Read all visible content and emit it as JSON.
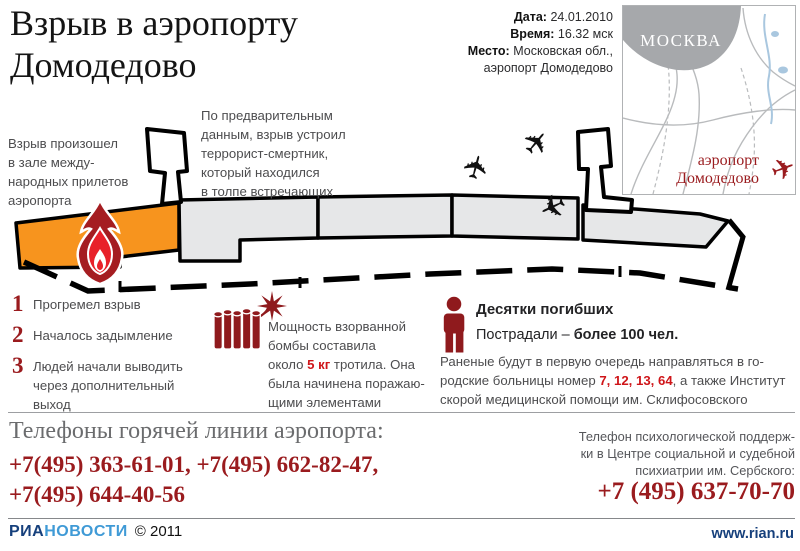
{
  "header": {
    "title": "Взрыв в аэропорту\nДомодедово",
    "meta": [
      {
        "label": "Дата:",
        "value": "24.01.2010"
      },
      {
        "label": "Время:",
        "value": "16.32 мск"
      },
      {
        "label": "Место:",
        "value": "Московская обл.,\nаэропорт Домодедово"
      }
    ]
  },
  "map": {
    "city_label": "МОСКВА",
    "airport_label": "аэропорт\nДомодедово",
    "plane_glyph": "✈"
  },
  "diagram": {
    "explosion_note": "Взрыв произошел\nв зале между-\nнародных прилетов\nаэропорта",
    "terrorist_note": "По предварительным\nданным, взрыв устроил\nтеррорист-смертник,\nкоторый находился\nв толпе встречающих",
    "plane_glyph": "✈"
  },
  "timeline": {
    "items": [
      {
        "num": "1",
        "text": "Прогремел взрыв"
      },
      {
        "num": "2",
        "text": "Началось задымление"
      },
      {
        "num": "3",
        "text": "Людей начали выводить\nчерез дополнительный\nвыход"
      }
    ]
  },
  "bomb": {
    "text_start": "Мощность взорванной\nбомбы составила\nоколо ",
    "highlight": "5 кг",
    "text_end": " тротила. Она\nбыла начинена поражаю-\nщими элементами"
  },
  "casualties": {
    "dead": "Десятки погибших",
    "injured_prefix": "Пострадали – ",
    "injured_value": "более 100 чел.",
    "hospitals_start": "Раненые будут в первую очередь направляться в го-\nродские больницы номер ",
    "hospitals_numbers": "7, 12, 13, 64",
    "hospitals_end": ", а также Институт\nскорой медицинской помощи им. Склифосовского"
  },
  "hotline": {
    "heading": "Телефоны горячей линии аэропорта:",
    "phones": "+7(495) 363-61-01, +7(495) 662-82-47,\n+7(495) 644-40-56"
  },
  "psych_support": {
    "text": "Телефон психологической поддерж-\nки в Центре социальной и судебной\nпсихиатрии им. Сербского:",
    "phone": "+7 (495) 637-70-70"
  },
  "footer": {
    "brand_part1": "РИА",
    "brand_part2": "НОВОСТИ",
    "copyright": "© 2011",
    "website": "www.rian.ru"
  },
  "colors": {
    "accent_dark_red": "#9a1b1e",
    "accent_bright_red": "#cf1519",
    "hall_orange": "#f7941e",
    "terminal_gray": "#e6e7e8",
    "brand_blue_dark": "#16407c",
    "brand_blue_light": "#3f9ad6"
  }
}
